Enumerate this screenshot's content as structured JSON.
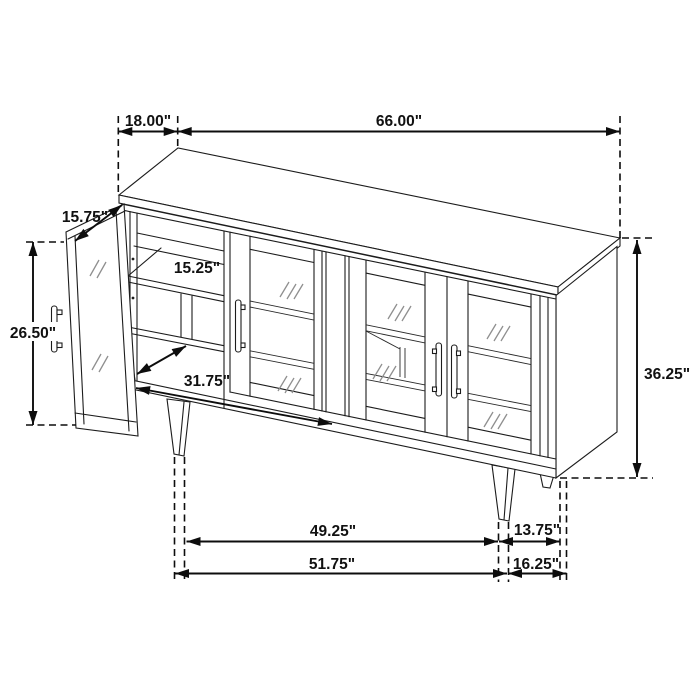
{
  "diagram": {
    "background_color": "#ffffff",
    "line_color": "#1c1c1c",
    "dimension_color": "#0d0d0d",
    "glass_mark_color": "#8f8f8f",
    "product": "sideboard-accent-cabinet-dimension-drawing",
    "dimensions": {
      "top_depth": "18.00\"",
      "top_width": "66.00\"",
      "door_width": "15.75\"",
      "left_height": "26.50\"",
      "shelf_depth": "15.25\"",
      "interior_width": "31.75\"",
      "overall_height": "36.25\"",
      "front_leg_span": "49.25\"",
      "right_leg_inset": "13.75\"",
      "base_span": "51.75\"",
      "right_base_inset": "16.25\""
    }
  }
}
